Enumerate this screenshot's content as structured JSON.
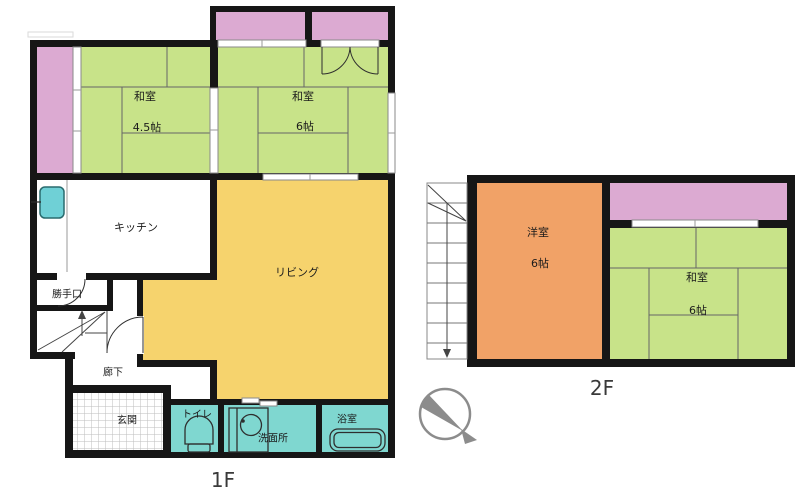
{
  "title": "floor-plan",
  "floor1": {
    "label": "1F",
    "washitsu45": {
      "name": "和室",
      "size": "4.5帖"
    },
    "washitsu6": {
      "name": "和室",
      "size": "6帖"
    },
    "kitchen": "キッチン",
    "living": "リビング",
    "backdoor": "勝手口",
    "hallway": "廊下",
    "entrance": "玄関",
    "toilet": "トイレ",
    "washroom": "洗面所",
    "bathroom": "浴室"
  },
  "floor2": {
    "label": "2F",
    "western": {
      "name": "洋室",
      "size": "6帖"
    },
    "washitsu6": {
      "name": "和室",
      "size": "6帖"
    }
  },
  "colors": {
    "tatami_green": "#c8e389",
    "veranda_pink": "#dcaad2",
    "living_yellow": "#f6d36d",
    "western_orange": "#f1a267",
    "wet_area_teal": "#7fd7d0",
    "sink_teal": "#6fd0d6",
    "wall_black": "#161616"
  },
  "icons": {
    "compass": "north-arrow-compass",
    "toilet": "toilet-icon",
    "washbasin": "washbasin-icon",
    "bathtub": "bathtub-icon",
    "kitchen_sink": "kitchen-sink-icon",
    "stairs_1f": "stairs-up-arrow",
    "stairs_2f": "stairs-down-arrow"
  }
}
